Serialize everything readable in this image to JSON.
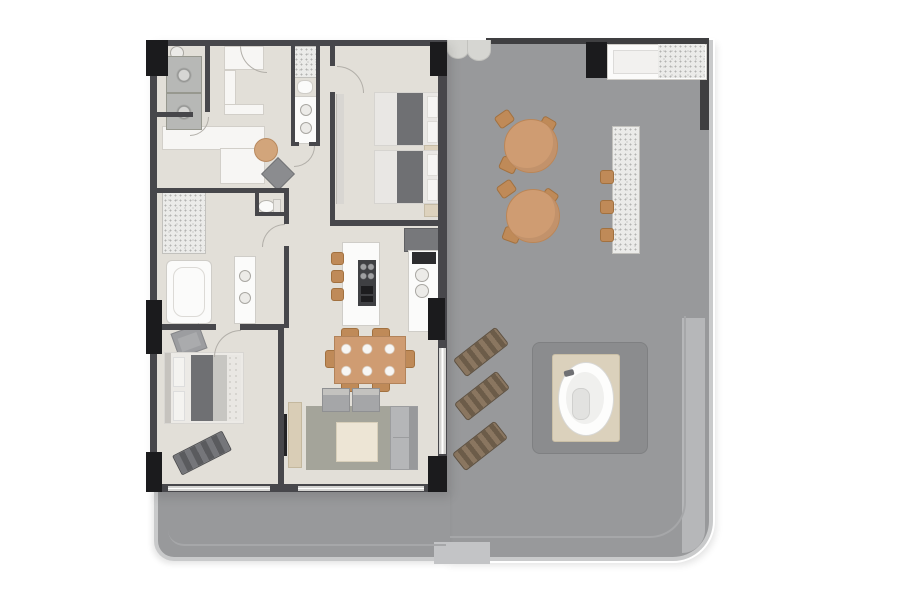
{
  "visible_text": [],
  "palette": {
    "page_bg": "#ffffff",
    "unit_floor": "#e2dfd8",
    "corridor_white": "#f7f6f4",
    "terrace_floor": "#98999b",
    "terrace_railing": "#c9cacb",
    "terrace_step": "#b6b7b9",
    "wall": "#47474b",
    "column": "#1b1b1d",
    "window": "#d4d4d2",
    "wood_tan": "#cf9c72",
    "chair_tan": "#bf8a58",
    "lounger_brown": "#8a7660",
    "rug": "#a4a49a",
    "sofa_gray": "#b5b6b8",
    "blanket_gray": "#6f7073",
    "deck_beige": "#dbd1bc",
    "hot_tub_platform": "#8b8c8e",
    "appliance_gray": "#b7b8b6",
    "granite": "#ebebe9"
  },
  "plan": {
    "type": "residential floor plan with wrap-around terrace",
    "unit_rooms": [
      {
        "name": "laundry",
        "furniture": [
          "stacked-washer-dryer",
          "utility-sink"
        ]
      },
      {
        "name": "entry-hall",
        "furniture": [
          "built-in-closets",
          "console-table",
          "ottoman"
        ]
      },
      {
        "name": "bathroom-2",
        "furniture": [
          "shower",
          "toilet",
          "double-sink-vanity"
        ]
      },
      {
        "name": "bedroom-2",
        "furniture": [
          "double-bed",
          "double-bed",
          "nightstand",
          "nightstand",
          "wardrobe"
        ]
      },
      {
        "name": "master-bathroom",
        "furniture": [
          "shower",
          "bathtub",
          "double-sink-vanity",
          "toilet"
        ]
      },
      {
        "name": "master-bedroom",
        "furniture": [
          "king-bed",
          "armchair",
          "bench"
        ]
      },
      {
        "name": "kitchen",
        "furniture": [
          "island-with-cooktop",
          "bar-stools",
          "counter-with-sinks",
          "oven",
          "refrigerator"
        ]
      },
      {
        "name": "dining-area",
        "furniture": [
          "dining-table-6-seats"
        ]
      },
      {
        "name": "living-room",
        "furniture": [
          "sofa",
          "armchair",
          "armchair",
          "coffee-table",
          "rug",
          "tv-console",
          "tv"
        ]
      }
    ],
    "terrace": {
      "name": "wrap-around-terrace",
      "furniture": [
        "outdoor-kitchen-counter",
        "bar-counter",
        "bar-stools",
        "cafe-table",
        "cafe-table",
        "cafe-chairs",
        "sun-lounger",
        "sun-lounger",
        "sun-lounger",
        "hot-tub"
      ]
    }
  }
}
